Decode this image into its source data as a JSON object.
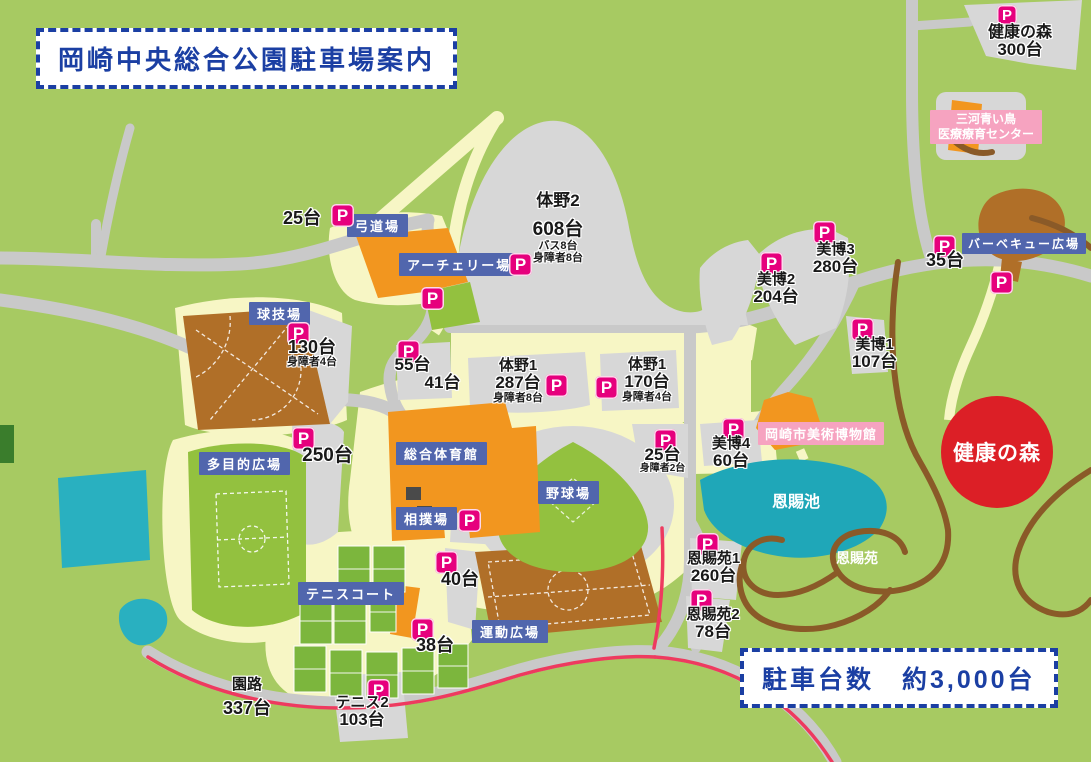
{
  "title": "岡崎中央総合公園駐車場案内",
  "summary_box": "駐車台数　約3,000台",
  "icons": {
    "p": "P"
  },
  "colors": {
    "p_icon": "#e6007d",
    "facility_label_blue": "#5166ad",
    "pink_label": "#f6a3c0",
    "title_blue": "#1b3fa3",
    "map_green": "#a7ca62",
    "pond_teal": "#1fa7b8",
    "field_brown": "#b06f28",
    "building_orange": "#f2961f",
    "kenko_circle_red": "#dc1f26"
  },
  "facilities": {
    "kyudojo": "弓道場",
    "archery": "アーチェリー場",
    "kyugijo": "球技場",
    "tamokuteki": "多目的広場",
    "sogo_taiikukan": "総合体育館",
    "sumojo": "相撲場",
    "tennis_court": "テニスコート",
    "undo_hiroba": "運動広場",
    "yakyujo": "野球場",
    "bbq_hiroba": "バーベキュー広場"
  },
  "pink_labels": {
    "mikawa_line1": "三河青い鳥",
    "mikawa_line2": "医療療育センター",
    "museum": "岡崎市美術博物館"
  },
  "areas": {
    "onshi_ike": "恩賜池",
    "onshi_en": "恩賜苑",
    "kenko_no_mori": "健康の森"
  },
  "parkings": {
    "kenko_top": {
      "name": "健康の森",
      "count": "300台"
    },
    "kyudo_25": {
      "count": "25台"
    },
    "taino2": {
      "name": "体野2",
      "count": "608台",
      "sub1": "バス8台",
      "sub2": "身障者8台"
    },
    "bihaku3": {
      "name": "美博3",
      "count": "280台"
    },
    "bihaku2": {
      "name": "美博2",
      "count": "204台"
    },
    "bbq_35": {
      "count": "35台"
    },
    "kyugijo_130": {
      "count": "130台",
      "sub1": "身障者4台"
    },
    "p55": {
      "count": "55台"
    },
    "p41": {
      "count": "41台"
    },
    "taino1_west": {
      "name": "体野1",
      "count": "287台",
      "sub1": "身障者8台"
    },
    "taino1_east": {
      "name": "体野1",
      "count": "170台",
      "sub1": "身障者4台"
    },
    "bihaku1": {
      "name": "美博1",
      "count": "107台"
    },
    "tamokuteki_250": {
      "count": "250台"
    },
    "hakubutsukan_25": {
      "count": "25台",
      "sub1": "身障者2台"
    },
    "bihaku4": {
      "name": "美博4",
      "count": "60台"
    },
    "sumo_40": {
      "count": "40台"
    },
    "tennis_38": {
      "count": "38台"
    },
    "onshien1": {
      "name": "恩賜苑1",
      "count": "260台"
    },
    "onshien2": {
      "name": "恩賜苑2",
      "count": "78台"
    },
    "enro": {
      "name": "園路",
      "count": "337台"
    },
    "tennis2": {
      "name": "テニス2",
      "count": "103台"
    }
  }
}
